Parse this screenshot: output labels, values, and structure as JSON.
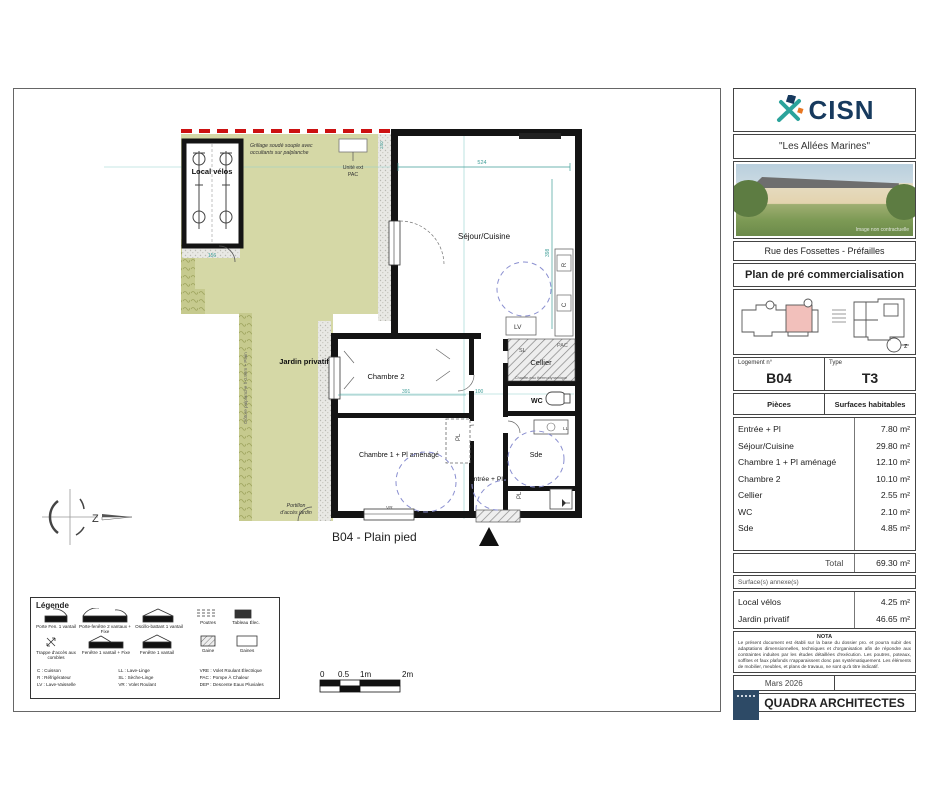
{
  "project": {
    "brand": "CISN",
    "title": "\"Les Allées Marines\"",
    "photo_caption": "Image non contractuelle",
    "address": "Rue des Fossettes - Préfailles",
    "doc_title": "Plan de pré commercialisation"
  },
  "unit": {
    "logement_label": "Logement n°",
    "logement": "B04",
    "type_label": "Type",
    "type": "T3"
  },
  "surfaces": {
    "col_piece": "Pièces",
    "col_surface": "Surfaces habitables",
    "rows": [
      {
        "label": "Entrée + Pl",
        "value": "7.80 m²"
      },
      {
        "label": "Séjour/Cuisine",
        "value": "29.80 m²"
      },
      {
        "label": "Chambre 1 + Pl aménagé",
        "value": "12.10 m²"
      },
      {
        "label": "Chambre 2",
        "value": "10.10 m²"
      },
      {
        "label": "Cellier",
        "value": "2.55 m²"
      },
      {
        "label": "WC",
        "value": "2.10 m²"
      },
      {
        "label": "Sde",
        "value": "4.85 m²"
      }
    ],
    "total_label": "Total",
    "total_value": "69.30 m²",
    "annex_header": "Surface(s) annexe(s)",
    "annex_rows": [
      {
        "label": "Local vélos",
        "value": "4.25 m²"
      },
      {
        "label": "Jardin privatif",
        "value": "46.65 m²"
      }
    ]
  },
  "nota": {
    "title": "NOTA",
    "text": "Le présent document est établi sur la base du dossier pro. et pourra subir des adaptations dimensionnelles, techniques et d'organisation afin de répondre aux contraintes induites par les études détaillées d'exécution. Les poutres, poteaux, soffites et faux plafonds n'apparaissent donc pas systématiquement. Les éléments de mobilier, meubles, et plans de travaux, ne sont qu'à titre indicatif."
  },
  "footer": {
    "date": "Mars 2026",
    "architect": "QUADRA ARCHITECTES"
  },
  "plan": {
    "caption": "B04 - Plain pied",
    "labels": {
      "local_velos": "Local vélos",
      "jardin": "Jardin privatif",
      "sejour": "Séjour/Cuisine",
      "chambre2": "Chambre 2",
      "chambre1": "Chambre 1 + Pl aménagé",
      "entree": "Entrée + Pl",
      "sde": "Sde",
      "cellier": "Cellier",
      "wc": "WC",
      "lv": "LV",
      "sl": "SL",
      "ll": "LL",
      "pac": "PAC",
      "pl": "PL",
      "pl2": "PL",
      "r": "R",
      "c": "C",
      "vr": "VR",
      "grillage1": "Grillage soudé souple avec",
      "grillage2": "occultants sur palplanche",
      "unite1": "Unité ext",
      "unite2": "PAC",
      "portillon1": "Portillon",
      "portillon2": "d'accès jardin",
      "cloture": "Clôture palplanche h 0.90m + Plain",
      "chauffe_eau": "Chauffe-eau thermodynamique"
    },
    "dims": {
      "d524": "524",
      "d398": "398",
      "d391": "391",
      "d100": "100",
      "d156": "156",
      "d240": "240"
    }
  },
  "compass": {
    "letter": "Z",
    "keyplan_letter": "z"
  },
  "scalebar": {
    "t0": "0",
    "t1": "0.5",
    "t2": "1m",
    "t3": "2m"
  },
  "legend": {
    "title": "Légende",
    "items": [
      "Porte Fen. 1 vantail",
      "Porte-fenêtre 2 vantaux + Fixe",
      "Oscillo-battant 1 vantail",
      "Poutres",
      "Tableau Élec.",
      "Trappe d'accès aux combles",
      "Fenêtre 1 vantail + Fixe",
      "Fenêtre 1 vantail",
      "Gaine",
      "Gaines",
      "Sèche-Serviette",
      "Radiateur",
      "Dimensions et emplacements à titre indicatif"
    ],
    "abbrev": [
      "C : Cuisson",
      "R : Réfrigérateur",
      "LV : Lave-Vaisselle",
      "LL : Lave-Linge",
      "SL : Sèche-Linge",
      "VR : Volet Roulant",
      "VRE : Volet Roulant Électrique",
      "PAC : Pompe À Chaleur",
      "DEP : Descente Eaux Pluviales"
    ]
  },
  "colors": {
    "garden": "#d5d8a6",
    "wall": "#141414",
    "dim_teal": "#3f9e98",
    "limit_red": "#cc1111",
    "circle_blue": "#8a8fd0",
    "brand_navy": "#173a5e",
    "brand_teal": "#2ba39b",
    "brand_orange": "#e87722",
    "keyplan_pink": "#f2c0bb"
  }
}
